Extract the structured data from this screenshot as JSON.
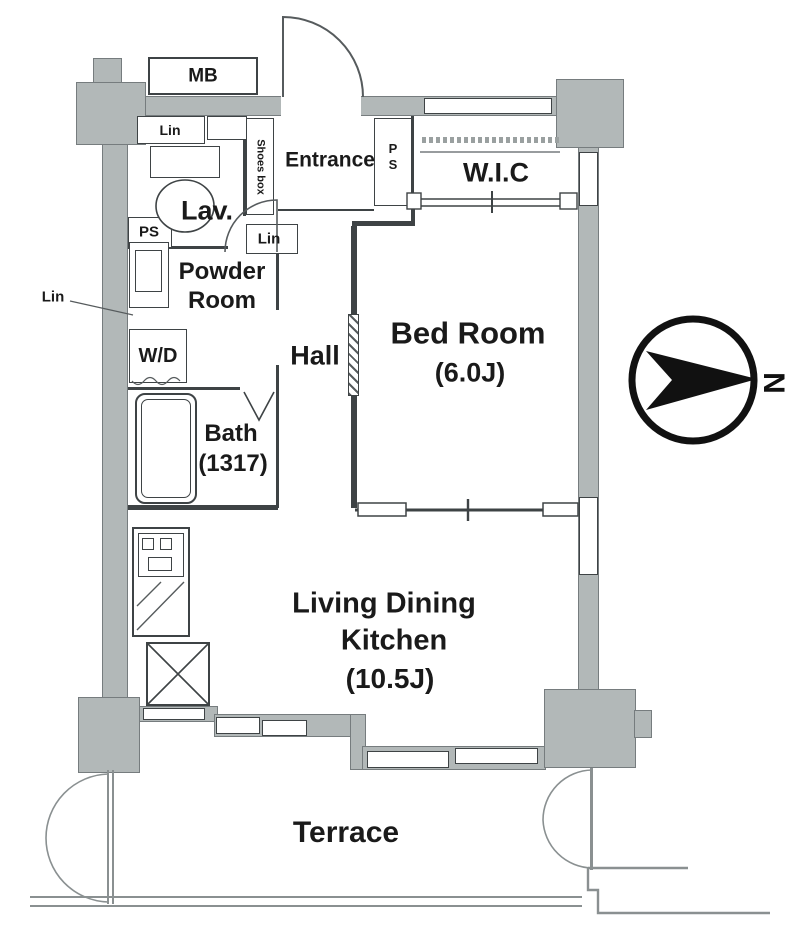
{
  "floorplan": {
    "colors": {
      "wall_fill": "#b2b8b8",
      "wall_edge": "#767c7e",
      "line": "#3e4345",
      "light_line": "#8a9091",
      "background": "#ffffff",
      "text": "#1a1a1a"
    },
    "labels": {
      "mb": "MB",
      "lin_top": "Lin",
      "lav": "Lav.",
      "ps_left": "PS",
      "powder_line1": "Powder",
      "powder_line2": "Room",
      "lin_left": "Lin",
      "wd": "W/D",
      "hall": "Hall",
      "bath_line1": "Bath",
      "bath_line2": "(1317)",
      "entrance": "Entrance",
      "shoes_box": "Shoes box",
      "ps_right": "PS",
      "lin_mid": "Lin",
      "wic": "W.I.C",
      "bedroom_line1": "Bed Room",
      "bedroom_line2": "(6.0J)",
      "ldk_line1": "Living Dining",
      "ldk_line2": "Kitchen",
      "ldk_line3": "(10.5J)",
      "terrace": "Terrace",
      "compass_n": "N"
    }
  }
}
